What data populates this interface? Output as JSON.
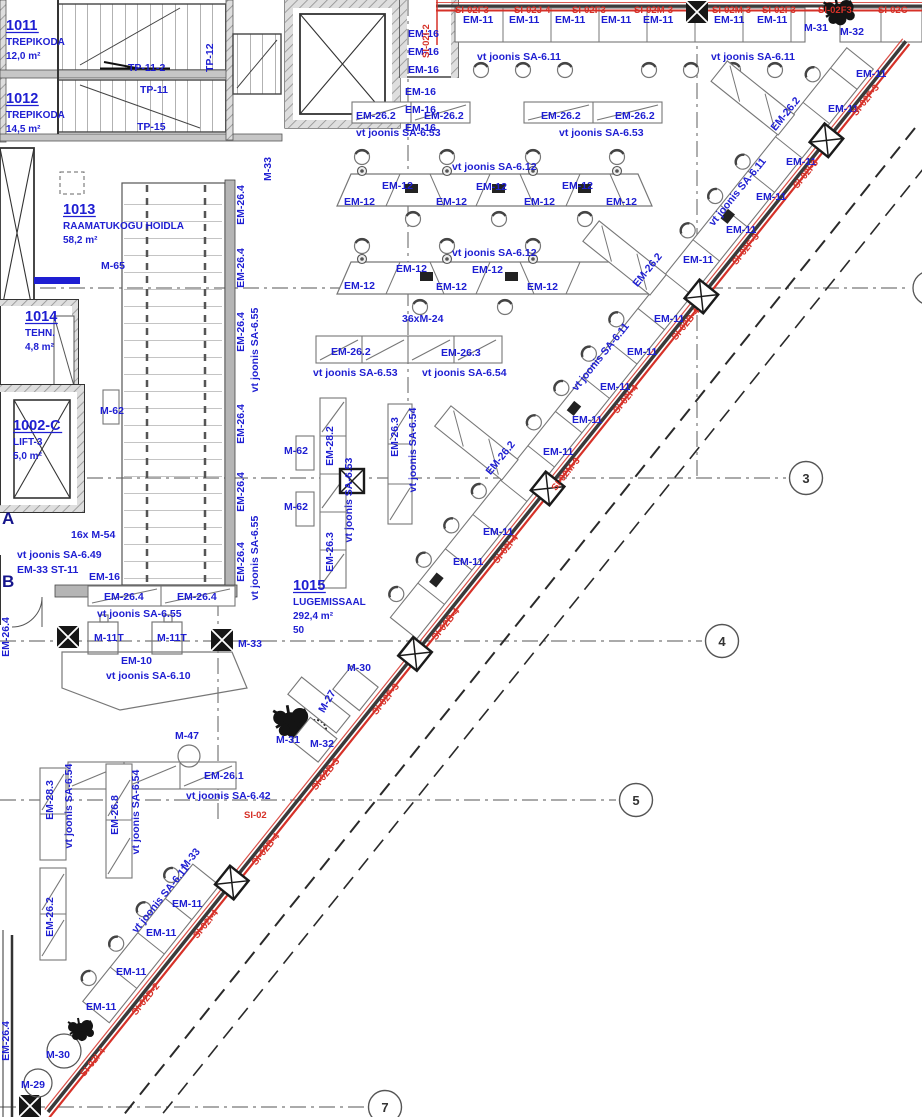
{
  "colors": {
    "blue": "#1e1ed2",
    "red": "#d63128",
    "dark": "#333333",
    "wall": "#b9b9b9",
    "line": "#555555"
  },
  "rooms": [
    {
      "number": "1011",
      "name": "TREPIKODA",
      "area": "12,0 m²",
      "x": 6,
      "y": 30
    },
    {
      "number": "1012",
      "name": "TREPIKODA",
      "area": "14,5 m²",
      "x": 6,
      "y": 103
    },
    {
      "number": "1013",
      "name": "RAAMATUKOGU HOIDLA",
      "area": "58,2 m²",
      "x": 63,
      "y": 214
    },
    {
      "number": "1014",
      "name": "TEHN.",
      "area": "4,8 m²",
      "x": 25,
      "y": 321
    },
    {
      "number": "1002-C",
      "name": "LIFT-3",
      "area": "5,0 m²",
      "x": 13,
      "y": 430
    },
    {
      "number": "1015",
      "name": "LUGEMISSAAL",
      "area": "292,4 m²",
      "capacity": "50",
      "x": 293,
      "y": 590
    }
  ],
  "grid": {
    "circles": [
      {
        "label": "3",
        "x": 806,
        "y": 478
      },
      {
        "label": "4",
        "x": 722,
        "y": 641
      },
      {
        "label": "5",
        "x": 636,
        "y": 800
      },
      {
        "label": "7",
        "x": 385,
        "y": 1107
      }
    ],
    "letters": [
      {
        "label": "A",
        "x": 2,
        "y": 524
      },
      {
        "label": "B",
        "x": 2,
        "y": 587
      }
    ]
  },
  "annotations": [
    {
      "t": "TP-11-2",
      "x": 128,
      "y": 71
    },
    {
      "t": "TP-12",
      "x": 213,
      "y": 72,
      "r": -90
    },
    {
      "t": "TP-11",
      "x": 140,
      "y": 93
    },
    {
      "t": "TP-15",
      "x": 137,
      "y": 130
    },
    {
      "t": "M-33",
      "x": 271,
      "y": 181,
      "r": -90
    },
    {
      "t": "EM-16",
      "x": 408,
      "y": 37
    },
    {
      "t": "EM-16",
      "x": 408,
      "y": 55
    },
    {
      "t": "EM-16",
      "x": 408,
      "y": 73
    },
    {
      "t": "EM-16",
      "x": 405,
      "y": 95
    },
    {
      "t": "EM-16",
      "x": 405,
      "y": 113
    },
    {
      "t": "EM-16",
      "x": 405,
      "y": 131
    },
    {
      "t": "SI-02F3",
      "x": 455,
      "y": 13,
      "c": "red",
      "s": 9.5
    },
    {
      "t": "SI-02J-4",
      "x": 514,
      "y": 13,
      "c": "red",
      "s": 9.5
    },
    {
      "t": "SI-02F3",
      "x": 572,
      "y": 13,
      "c": "red",
      "s": 9.5
    },
    {
      "t": "SI-02M-3",
      "x": 634,
      "y": 13,
      "c": "red",
      "s": 9.5
    },
    {
      "t": "SI-02M-3",
      "x": 712,
      "y": 13,
      "c": "red",
      "s": 9.5
    },
    {
      "t": "SI-02F3",
      "x": 762,
      "y": 13,
      "c": "red",
      "s": 9.5
    },
    {
      "t": "SI-02F3",
      "x": 818,
      "y": 13,
      "c": "red",
      "s": 9.5
    },
    {
      "t": "SI-02C",
      "x": 878,
      "y": 13,
      "c": "red",
      "s": 9.5
    },
    {
      "t": "SI-02I-2",
      "x": 429,
      "y": 58,
      "r": -90,
      "c": "red",
      "s": 9.5
    },
    {
      "t": "EM-11",
      "x": 463,
      "y": 23
    },
    {
      "t": "EM-11",
      "x": 509,
      "y": 23
    },
    {
      "t": "EM-11",
      "x": 555,
      "y": 23
    },
    {
      "t": "EM-11",
      "x": 601,
      "y": 23
    },
    {
      "t": "EM-11",
      "x": 643,
      "y": 23
    },
    {
      "t": "EM-11",
      "x": 714,
      "y": 23
    },
    {
      "t": "EM-11",
      "x": 757,
      "y": 23
    },
    {
      "t": "M-31",
      "x": 804,
      "y": 31
    },
    {
      "t": "M-32",
      "x": 840,
      "y": 35
    },
    {
      "t": "vt joonis SA-6.11",
      "x": 477,
      "y": 60
    },
    {
      "t": "vt joonis SA-6.11",
      "x": 711,
      "y": 60
    },
    {
      "t": "EM-26.2",
      "x": 356,
      "y": 119
    },
    {
      "t": "EM-26.2",
      "x": 424,
      "y": 119
    },
    {
      "t": "EM-26.2",
      "x": 541,
      "y": 119
    },
    {
      "t": "EM-26.2",
      "x": 615,
      "y": 119
    },
    {
      "t": "vt joonis SA-6.53",
      "x": 356,
      "y": 136
    },
    {
      "t": "vt joonis SA-6.53",
      "x": 559,
      "y": 136
    },
    {
      "t": "vt joonis SA-6.12",
      "x": 452,
      "y": 170
    },
    {
      "t": "EM-12",
      "x": 344,
      "y": 205
    },
    {
      "t": "EM-12",
      "x": 382,
      "y": 189
    },
    {
      "t": "EM-12",
      "x": 436,
      "y": 205
    },
    {
      "t": "EM-12",
      "x": 476,
      "y": 190
    },
    {
      "t": "EM-12",
      "x": 524,
      "y": 205
    },
    {
      "t": "EM-12",
      "x": 562,
      "y": 189
    },
    {
      "t": "EM-12",
      "x": 606,
      "y": 205
    },
    {
      "t": "vt joonis SA-6.12",
      "x": 452,
      "y": 256
    },
    {
      "t": "EM-12",
      "x": 344,
      "y": 289
    },
    {
      "t": "EM-12",
      "x": 396,
      "y": 272
    },
    {
      "t": "EM-12",
      "x": 436,
      "y": 290
    },
    {
      "t": "EM-12",
      "x": 472,
      "y": 273
    },
    {
      "t": "EM-12",
      "x": 527,
      "y": 290
    },
    {
      "t": "36xM-24",
      "x": 402,
      "y": 322
    },
    {
      "t": "M-65",
      "x": 101,
      "y": 269
    },
    {
      "t": "M-62",
      "x": 100,
      "y": 414
    },
    {
      "t": "M-62",
      "x": 284,
      "y": 454
    },
    {
      "t": "M-62",
      "x": 284,
      "y": 510
    },
    {
      "t": "EM-26.2",
      "x": 331,
      "y": 355
    },
    {
      "t": "EM-26.3",
      "x": 441,
      "y": 356
    },
    {
      "t": "vt joonis SA-6.53",
      "x": 313,
      "y": 376
    },
    {
      "t": "vt joonis SA-6.54",
      "x": 422,
      "y": 376
    },
    {
      "t": "EM-26.4",
      "x": 244,
      "y": 205,
      "r": -90,
      "a": "m"
    },
    {
      "t": "EM-26.4",
      "x": 244,
      "y": 268,
      "r": -90,
      "a": "m"
    },
    {
      "t": "EM-26.4",
      "x": 244,
      "y": 332,
      "r": -90,
      "a": "m"
    },
    {
      "t": "EM-26.4",
      "x": 244,
      "y": 424,
      "r": -90,
      "a": "m"
    },
    {
      "t": "EM-26.4",
      "x": 244,
      "y": 492,
      "r": -90,
      "a": "m"
    },
    {
      "t": "EM-26.4",
      "x": 244,
      "y": 562,
      "r": -90,
      "a": "m"
    },
    {
      "t": "vt joonis SA-6.55",
      "x": 258,
      "y": 350,
      "r": -90,
      "a": "m"
    },
    {
      "t": "vt joonis SA-6.55",
      "x": 258,
      "y": 558,
      "r": -90,
      "a": "m"
    },
    {
      "t": "EM-28.2",
      "x": 333,
      "y": 446,
      "r": -90,
      "a": "m"
    },
    {
      "t": "vt joonis SA-6.53",
      "x": 352,
      "y": 500,
      "r": -90,
      "a": "m"
    },
    {
      "t": "EM-26.3",
      "x": 333,
      "y": 552,
      "r": -90,
      "a": "m"
    },
    {
      "t": "EM-26.3",
      "x": 398,
      "y": 437,
      "r": -90,
      "a": "m"
    },
    {
      "t": "vt joonis SA-6.54",
      "x": 416,
      "y": 450,
      "r": -90,
      "a": "m"
    },
    {
      "t": "16x M-54",
      "x": 71,
      "y": 538
    },
    {
      "t": "vt joonis SA-6.49",
      "x": 17,
      "y": 558
    },
    {
      "t": "EM-33 ST-11",
      "x": 17,
      "y": 573
    },
    {
      "t": "EM-16",
      "x": 89,
      "y": 580
    },
    {
      "t": "EM-26.4",
      "x": 104,
      "y": 600
    },
    {
      "t": "EM-26.4",
      "x": 177,
      "y": 600
    },
    {
      "t": "vt joonis SA-6.55",
      "x": 97,
      "y": 617
    },
    {
      "t": "M-11T",
      "x": 94,
      "y": 641
    },
    {
      "t": "M-11T",
      "x": 157,
      "y": 641
    },
    {
      "t": "M-33",
      "x": 238,
      "y": 647
    },
    {
      "t": "EM-10",
      "x": 121,
      "y": 664
    },
    {
      "t": "vt joonis SA-6.10",
      "x": 106,
      "y": 679
    },
    {
      "t": "M-30",
      "x": 347,
      "y": 671
    },
    {
      "t": "M-27",
      "x": 330,
      "y": 703,
      "r": -60,
      "a": "m"
    },
    {
      "t": "M-47",
      "x": 175,
      "y": 739
    },
    {
      "t": "M-31",
      "x": 276,
      "y": 743
    },
    {
      "t": "M-32",
      "x": 310,
      "y": 747
    },
    {
      "t": "EM-26.1",
      "x": 204,
      "y": 779
    },
    {
      "t": "vt joonis SA-6.42",
      "x": 186,
      "y": 799
    },
    {
      "t": "SI-02",
      "x": 244,
      "y": 818,
      "c": "red",
      "s": 9.5
    },
    {
      "t": "EM-28.3",
      "x": 53,
      "y": 800,
      "r": -90,
      "a": "m"
    },
    {
      "t": "vt joonis SA-6.54",
      "x": 72,
      "y": 806,
      "r": -90,
      "a": "m"
    },
    {
      "t": "EM-26.8",
      "x": 118,
      "y": 815,
      "r": -90,
      "a": "m"
    },
    {
      "t": "vt joonis SA-6.54",
      "x": 139,
      "y": 812,
      "r": -90,
      "a": "m"
    },
    {
      "t": "EM-26.2",
      "x": 53,
      "y": 917,
      "r": -90,
      "a": "m"
    },
    {
      "t": "EM-26.4",
      "x": 9,
      "y": 637,
      "r": -90,
      "a": "m"
    },
    {
      "t": "EM-26.4",
      "x": 9,
      "y": 1041,
      "r": -90,
      "a": "m"
    },
    {
      "t": "M-33",
      "x": 193,
      "y": 861,
      "r": -51,
      "a": "m"
    },
    {
      "t": "vt joonis SA-6.11",
      "x": 163,
      "y": 901,
      "r": -51,
      "a": "m"
    },
    {
      "t": "EM-11",
      "x": 172,
      "y": 907
    },
    {
      "t": "EM-11",
      "x": 146,
      "y": 936
    },
    {
      "t": "EM-11",
      "x": 116,
      "y": 975
    },
    {
      "t": "EM-11",
      "x": 86,
      "y": 1010
    },
    {
      "t": "M-30",
      "x": 46,
      "y": 1058
    },
    {
      "t": "M-29",
      "x": 21,
      "y": 1088
    },
    {
      "t": "EM-11",
      "x": 856,
      "y": 77
    },
    {
      "t": "EM-11",
      "x": 828,
      "y": 112
    },
    {
      "t": "EM-11",
      "x": 786,
      "y": 165
    },
    {
      "t": "EM-11",
      "x": 756,
      "y": 200
    },
    {
      "t": "EM-11",
      "x": 726,
      "y": 233
    },
    {
      "t": "EM-11",
      "x": 683,
      "y": 263
    },
    {
      "t": "EM-11",
      "x": 654,
      "y": 322
    },
    {
      "t": "EM-11",
      "x": 627,
      "y": 355
    },
    {
      "t": "EM-11",
      "x": 600,
      "y": 390
    },
    {
      "t": "EM-11",
      "x": 572,
      "y": 423
    },
    {
      "t": "EM-11",
      "x": 543,
      "y": 455
    },
    {
      "t": "EM-11",
      "x": 483,
      "y": 535
    },
    {
      "t": "EM-11",
      "x": 453,
      "y": 565
    },
    {
      "t": "EM-26.2",
      "x": 788,
      "y": 116,
      "r": -51,
      "a": "m"
    },
    {
      "t": "EM-26.2",
      "x": 650,
      "y": 272,
      "r": -51,
      "a": "m"
    },
    {
      "t": "EM-26.2",
      "x": 503,
      "y": 460,
      "r": -51,
      "a": "m"
    },
    {
      "t": "vt joonis SA-6.11",
      "x": 740,
      "y": 194,
      "r": -51,
      "a": "m"
    },
    {
      "t": "vt joonis SA-6.11",
      "x": 603,
      "y": 359,
      "r": -51,
      "a": "m"
    },
    {
      "t": "SI-02F-3",
      "x": 868,
      "y": 102,
      "r": -51,
      "c": "red",
      "s": 9.5,
      "a": "m"
    },
    {
      "t": "SI-02I-3",
      "x": 808,
      "y": 176,
      "r": -51,
      "c": "red",
      "s": 9.5,
      "a": "m"
    },
    {
      "t": "SI-02F-3",
      "x": 748,
      "y": 251,
      "r": -51,
      "c": "red",
      "s": 9.5,
      "a": "m"
    },
    {
      "t": "SI-02B-4",
      "x": 688,
      "y": 326,
      "r": -51,
      "c": "red",
      "s": 9.5,
      "a": "m"
    },
    {
      "t": "SI-02I-4",
      "x": 628,
      "y": 401,
      "r": -51,
      "c": "red",
      "s": 9.5,
      "a": "m"
    },
    {
      "t": "SI-02M-3",
      "x": 568,
      "y": 476,
      "r": -51,
      "c": "red",
      "s": 9.5,
      "a": "m"
    },
    {
      "t": "SI-02I-4",
      "x": 508,
      "y": 551,
      "r": -51,
      "c": "red",
      "s": 9.5,
      "a": "m"
    },
    {
      "t": "SI-02B-4",
      "x": 448,
      "y": 626,
      "r": -51,
      "c": "red",
      "s": 9.5,
      "a": "m"
    },
    {
      "t": "SI-02F-3",
      "x": 388,
      "y": 701,
      "r": -51,
      "c": "red",
      "s": 9.5,
      "a": "m"
    },
    {
      "t": "SI-02B-3",
      "x": 328,
      "y": 776,
      "r": -51,
      "c": "red",
      "s": 9.5,
      "a": "m"
    },
    {
      "t": "SI-02B-4",
      "x": 268,
      "y": 851,
      "r": -51,
      "c": "red",
      "s": 9.5,
      "a": "m"
    },
    {
      "t": "SI-02I-4",
      "x": 208,
      "y": 926,
      "r": -51,
      "c": "red",
      "s": 9.5,
      "a": "m"
    },
    {
      "t": "SI-02D-2",
      "x": 148,
      "y": 1001,
      "r": -51,
      "c": "red",
      "s": 9.5,
      "a": "m"
    },
    {
      "t": "SI-02I-4",
      "x": 95,
      "y": 1064,
      "r": -51,
      "c": "red",
      "s": 9.5,
      "a": "m"
    }
  ]
}
